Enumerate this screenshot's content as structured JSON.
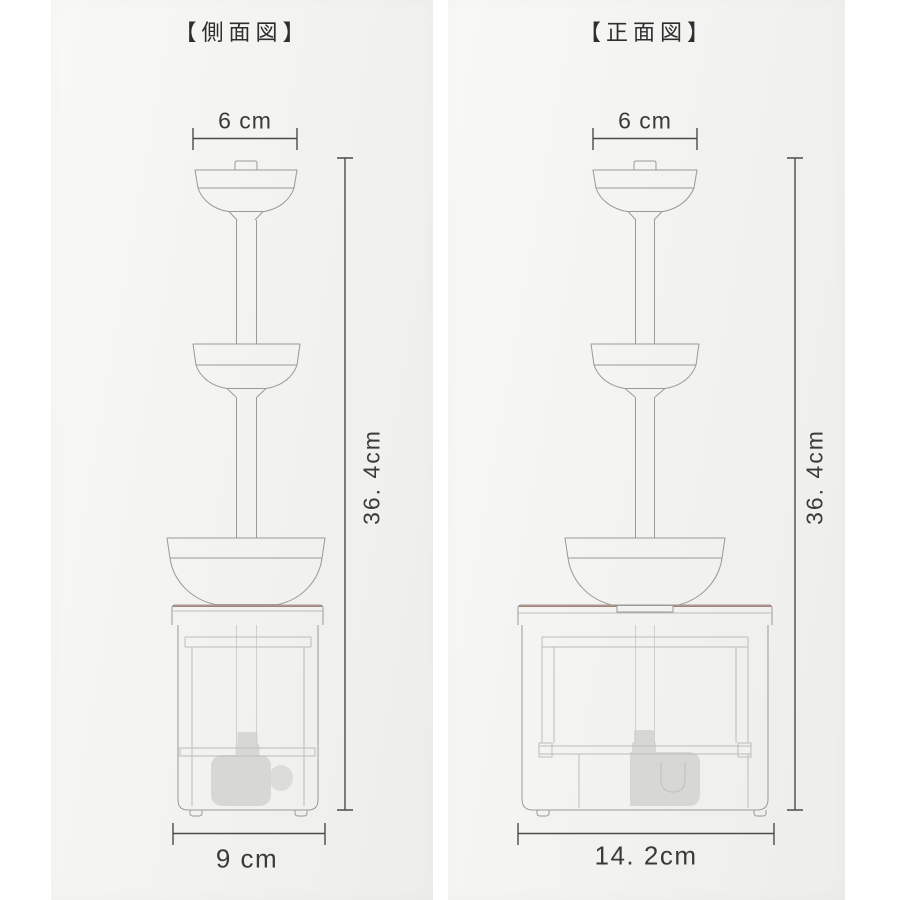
{
  "panels": {
    "side": {
      "title": "【側面図】",
      "top_width_label": "6 cm",
      "height_label": "36. 4cm",
      "base_width_label": "9 cm"
    },
    "front": {
      "title": "【正面図】",
      "top_width_label": "6 cm",
      "height_label": "36. 4cm",
      "base_width_label": "14. 2cm"
    }
  },
  "colors": {
    "background": "#ffffff",
    "card": "#f3f3f1",
    "outline": "#9a9a98",
    "inner_lines": "#bcbcba",
    "faint_lines": "#d0d0ce",
    "dimension": "#4b4b4b",
    "text": "#3a3a3a",
    "lid_accent": "#a97f72",
    "pump_fill": "#d7d7d5",
    "pump_line": "#c3c3c1"
  }
}
